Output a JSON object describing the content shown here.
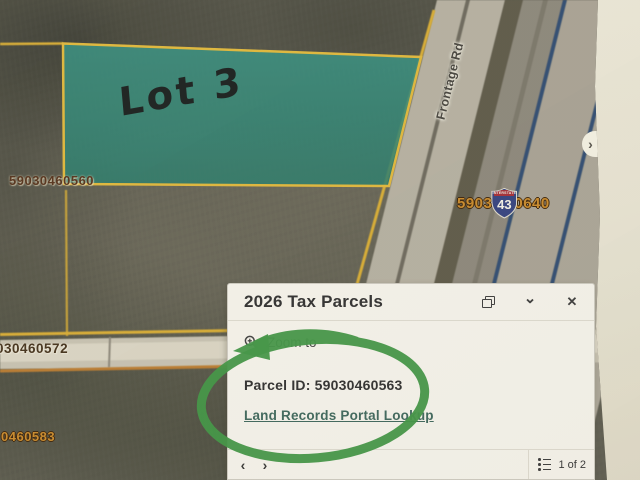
{
  "colors": {
    "paper_beige": "#e9e6d6",
    "map_base": "#5c5b4e",
    "parcel_highlight_teal": "#2f8c78",
    "parcel_line_yellow": "#d9ad35",
    "road_line_orange": "#b97a2e",
    "interstate_navy": "#2d4a70",
    "marker_green": "#3f9443",
    "panel_bg": "#f4f2ea",
    "link_green": "#3c655a",
    "label_orange": "#c8892a",
    "label_brown": "#53301a"
  },
  "map": {
    "highlight_label": "Lot 3",
    "road_label": "Frontage Rd",
    "parcel_labels": {
      "top_left": "59030460560",
      "mid_clipped": "030460572",
      "bottom_clipped": "0460583",
      "near_shield_left": "5903",
      "near_shield_right": "0640"
    },
    "shield": {
      "top": "INTERSTATE",
      "number": "43"
    },
    "edge_chevron": "›"
  },
  "panel": {
    "title": "2026 Tax Parcels",
    "icons": {
      "collapse": "⌄",
      "close": "✕"
    },
    "zoom_to": "Zoom to",
    "parcel_id": "Parcel ID: 59030460563",
    "link": "Land Records Portal Lookup",
    "footer": {
      "prev": "‹",
      "next": "›",
      "page": "1 of 2"
    }
  }
}
